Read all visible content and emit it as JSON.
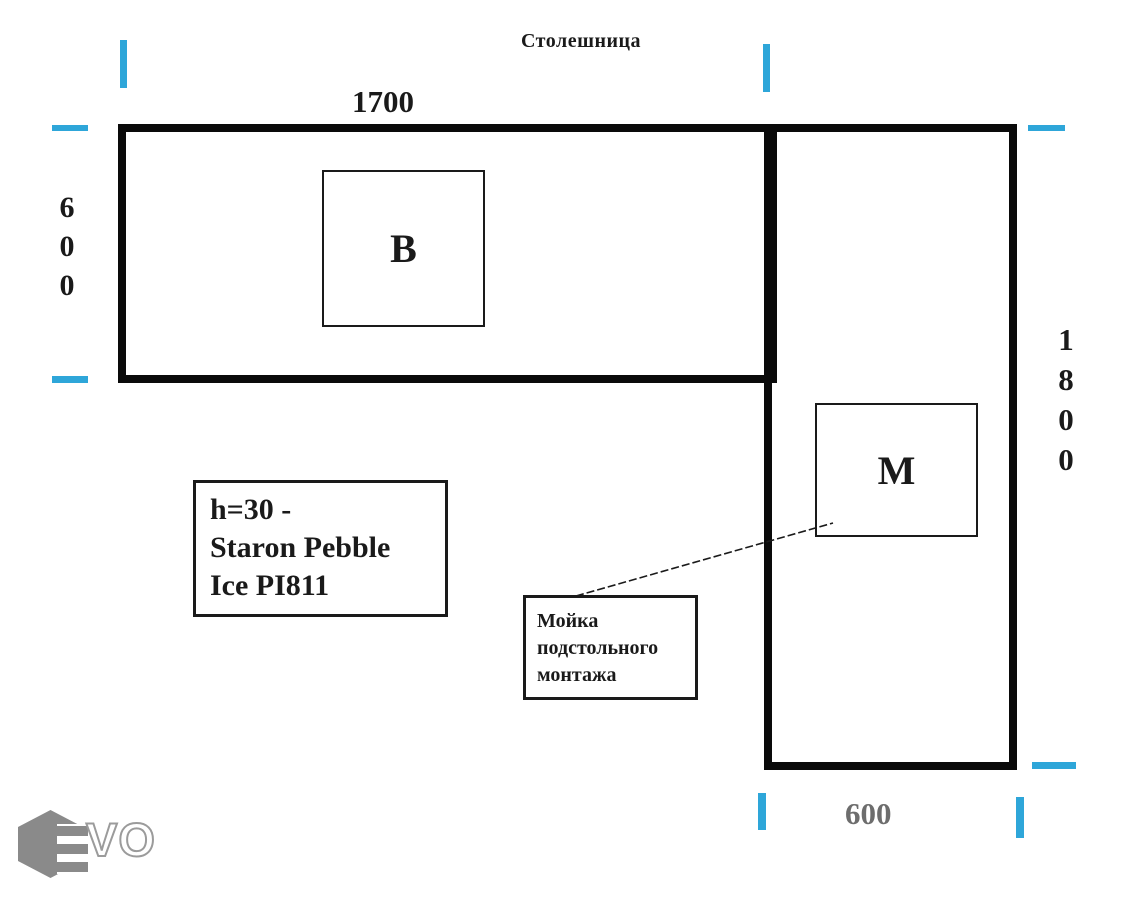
{
  "page": {
    "title": "Столешница"
  },
  "countertop": {
    "sections": {
      "horizontal": {
        "width_label": "1700",
        "depth_label": "600"
      },
      "vertical": {
        "height_label": "1800",
        "width_label": "600"
      }
    },
    "cutouts": {
      "cooktop": {
        "label": "В"
      },
      "sink": {
        "label": "М"
      }
    }
  },
  "notes": {
    "material": {
      "line1": "h=30 -",
      "line2": "Staron Pebble",
      "line3": "Ice PI811"
    },
    "sink": {
      "line1": "Мойка",
      "line2": "подстольного",
      "line3": "монтажа"
    }
  },
  "logo": {
    "text": "VO"
  },
  "colors": {
    "tick_cyan": "#2ea6d9",
    "outline_black": "#0a0a0a",
    "bottom_dim_gray": "#6d6d6d",
    "logo_gray": "#8a8a8a"
  }
}
